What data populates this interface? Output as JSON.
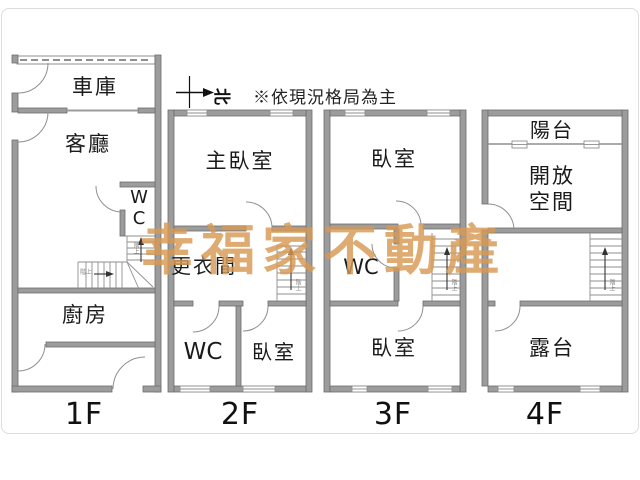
{
  "note": "※依現況格局為主",
  "compass": {
    "north_label": "北"
  },
  "watermark": {
    "text": "幸福家不動產",
    "color": "#d79a55"
  },
  "colors": {
    "wall": "#9c9c9c",
    "wall_outline": "#6d6d6d",
    "thin_line": "#8f8f8f",
    "text": "#1a1a1a"
  },
  "stairs": {
    "up_note": "階上"
  },
  "floors": [
    {
      "label": "1F",
      "rooms": {
        "garage": "車庫",
        "living": "客廳",
        "wc": "WC",
        "kitchen": "廚房"
      }
    },
    {
      "label": "2F",
      "rooms": {
        "master": "主臥室",
        "dressing": "更衣間",
        "wc": "WC",
        "bedroom": "臥室"
      }
    },
    {
      "label": "3F",
      "rooms": {
        "bedroom_top": "臥室",
        "wc": "WC",
        "bedroom_bottom": "臥室"
      }
    },
    {
      "label": "4F",
      "rooms": {
        "balcony": "陽台",
        "open_space": "開放\n空間",
        "terrace": "露台"
      }
    }
  ]
}
